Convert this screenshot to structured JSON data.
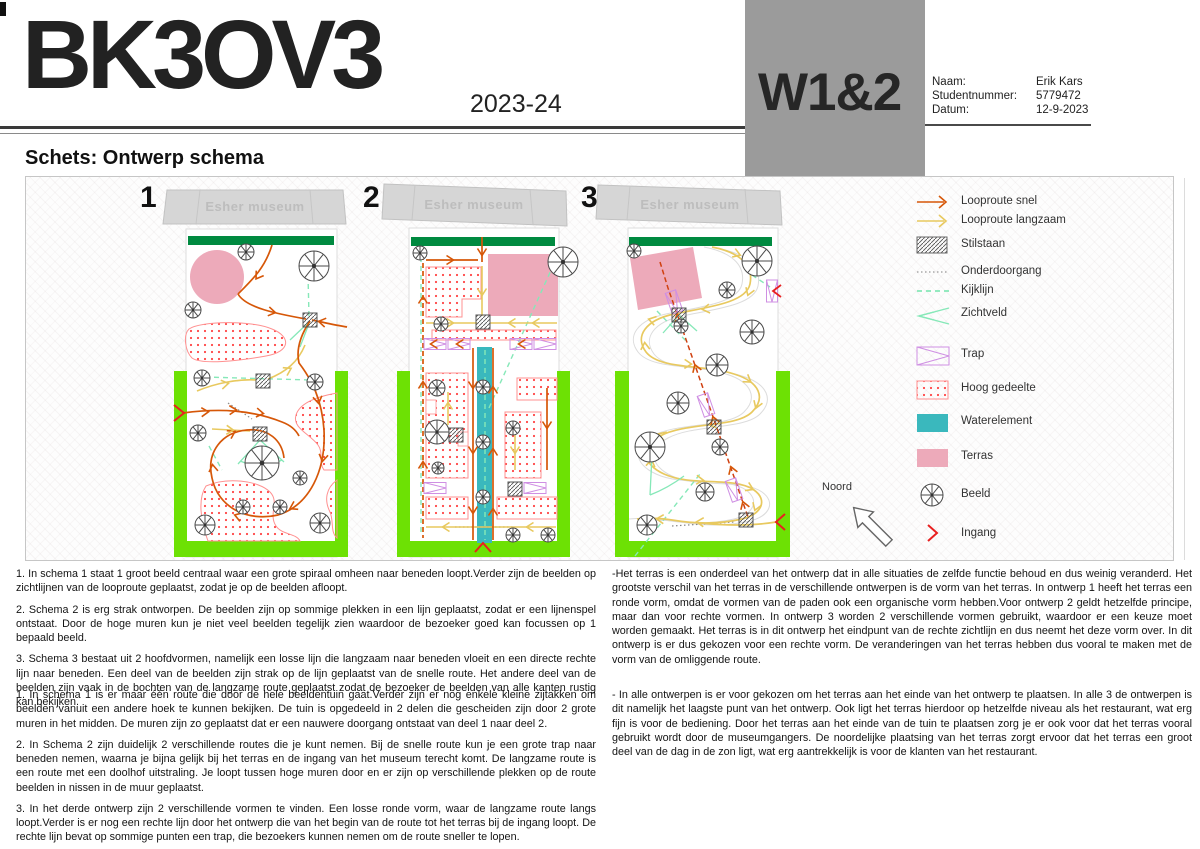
{
  "header": {
    "course_code": "BK3OV3",
    "year": "2023-24",
    "week_badge": "W1&2",
    "info_rows": [
      {
        "label": "Naam:",
        "value": "Erik Kars"
      },
      {
        "label": "Studentnummer:",
        "value": "5779472"
      },
      {
        "label": "Datum:",
        "value": "12-9-2023"
      }
    ]
  },
  "section_title": "Schets: Ontwerp schema",
  "schemas": [
    {
      "number": "1",
      "building_label": "Esher museum"
    },
    {
      "number": "2",
      "building_label": "Esher museum"
    },
    {
      "number": "3",
      "building_label": "Esher museum"
    }
  ],
  "legend": {
    "north_label": "Noord",
    "items": [
      {
        "label": "Looproute snel",
        "icon": "fast-route-arrow-icon"
      },
      {
        "label": "Looproute langzaam",
        "icon": "slow-route-arrow-icon"
      },
      {
        "label": "Stilstaan",
        "icon": "hatched-box-icon"
      },
      {
        "label": "Onderdoorgang",
        "icon": "dotted-line-icon"
      },
      {
        "label": "Kijklijn",
        "icon": "dashed-mint-line-icon"
      },
      {
        "label": "Zichtveld",
        "icon": "view-cone-icon"
      },
      {
        "label": "Trap",
        "icon": "stairs-box-icon"
      },
      {
        "label": "Hoog gedeelte",
        "icon": "red-dotted-box-icon"
      },
      {
        "label": "Waterelement",
        "icon": "teal-box-icon"
      },
      {
        "label": "Terras",
        "icon": "pink-box-icon"
      },
      {
        "label": "Beeld",
        "icon": "statue-wheel-icon"
      },
      {
        "label": "Ingang",
        "icon": "red-chevron-icon"
      }
    ]
  },
  "notes": {
    "left_top": [
      "1. In schema 1 staat 1 groot beeld centraal waar een grote spiraal omheen naar beneden loopt.Verder zijn de beelden op zichtlijnen van de looproute geplaatst, zodat je op de beelden afloopt.",
      "2. Schema 2 is erg strak ontworpen. De beelden zijn op sommige plekken in een lijn geplaatst, zodat er een lijnenspel ontstaat. Door de hoge muren kun je niet veel beelden tegelijk zien waardoor de bezoeker goed kan focussen op 1 bepaald beeld.",
      "3. Schema 3 bestaat uit 2 hoofdvormen, namelijk een losse lijn die langzaam naar beneden vloeit en een directe rechte lijn naar beneden. Een deel van de beelden zijn strak op de lijn geplaatst van de snelle route. Het andere deel van de beelden zijn vaak in de bochten van de langzame route geplaatst zodat de bezoeker de beelden van alle kanten rustig kan bekijken."
    ],
    "left_bottom": [
      "1. In schema 1 is er maar één route die door de hele beeldentuin gaat.Verder zijn er nog enkele kleine zijtakken om beelden vanuit een andere hoek te kunnen bekijken. De tuin is opgedeeld in 2 delen die gescheiden zijn door 2 grote muren in het midden. De muren zijn zo geplaatst dat er een nauwere doorgang ontstaat van deel 1 naar deel 2.",
      "2. In Schema 2 zijn duidelijk 2 verschillende routes die je kunt nemen. Bij de snelle route kun je een grote trap naar beneden nemen, waarna je bijna gelijk bij het terras en de ingang van het museum terecht komt. De langzame route is een route met een doolhof uitstraling. Je loopt tussen hoge muren door en er zijn op verschillende plekken op de route beelden in nissen in de muur geplaatst.",
      "3. In het derde ontwerp zijn 2 verschillende vormen te vinden. Een losse ronde vorm, waar de langzame route langs loopt.Verder is er nog een rechte lijn door het ontwerp die van het begin van de route tot het terras bij de ingang loopt. De rechte lijn bevat op sommige punten een trap, die bezoekers kunnen nemen om de route sneller te lopen."
    ],
    "right_top": [
      "-Het terras is een onderdeel van het ontwerp dat in alle situaties de zelfde functie behoud en dus weinig veranderd. Het grootste verschil van het terras in de verschillende ontwerpen is de vorm van het terras. In ontwerp 1 heeft het terras een ronde vorm, omdat de vormen van de paden ook een organische vorm hebben.Voor ontwerp 2 geldt hetzelfde principe, maar dan voor rechte vormen. In ontwerp 3 worden 2 verschillende vormen gebruikt, waardoor er een keuze moet worden gemaakt. Het terras is in dit ontwerp het eindpunt van de rechte zichtlijn en dus neemt het deze vorm over. In dit ontwerp is er dus gekozen voor een rechte vorm. De veranderingen van het terras hebben dus vooral te maken met de vorm van de omliggende route."
    ],
    "right_bottom": [
      "- In alle ontwerpen is er voor gekozen om het terras aan het einde van het ontwerp te plaatsen. In alle 3 de ontwerpen is dit namelijk het laagste punt van het ontwerp. Ook ligt het terras hierdoor op hetzelfde niveau als het restaurant, wat erg fijn is voor de bediening. Door het terras aan het einde van de tuin te plaatsen zorg je er ook voor dat het terras vooral gebruikt wordt door de museumgangers. De noordelijke plaatsing van het terras zorgt ervoor dat het terras een groot deel van de dag in de zon ligt, wat erg aantrekkelijk is voor de klanten van het restaurant."
    ]
  },
  "colors": {
    "route_fast_orange": "#d65708",
    "route_slow_yellow": "#e8c95f",
    "sightline_mint": "#86e8b8",
    "stairs_purple": "#cf8fe3",
    "high_area_red": "#ff4545",
    "high_area_border": "#ff9090",
    "water_teal": "#3ab8bd",
    "terras_pink": "#edaaba",
    "hedge_darkgreen": "#008a40",
    "border_lime": "#6de104",
    "entrance_red": "#e82020",
    "museum_gray": "#d6d6d6",
    "badge_gray": "#9b9b9b"
  }
}
